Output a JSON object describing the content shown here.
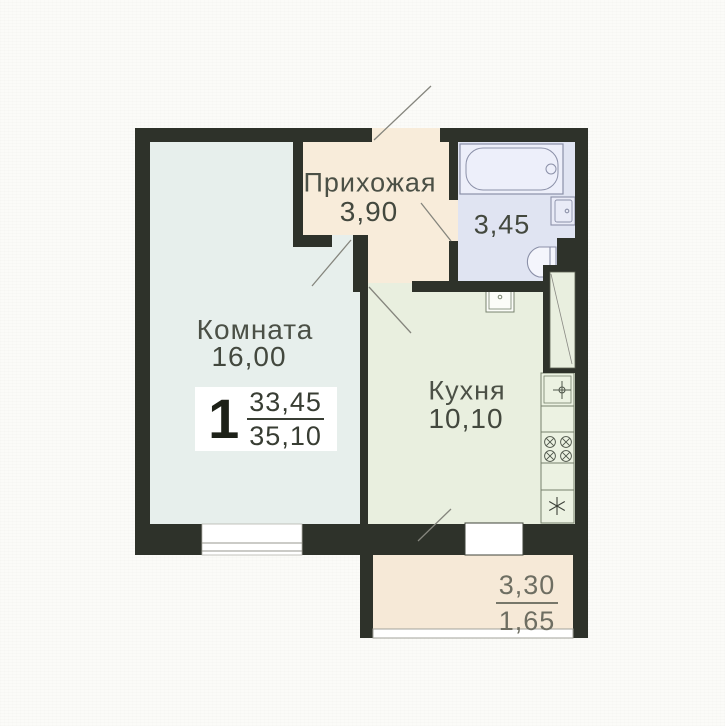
{
  "floor_plan": {
    "rooms": [
      {
        "id": "hallway",
        "name": "Прихожая",
        "area": "3,90"
      },
      {
        "id": "living-room",
        "name": "Комната",
        "area": "16,00"
      },
      {
        "id": "kitchen",
        "name": "Кухня",
        "area": "10,10"
      },
      {
        "id": "bathroom",
        "name": "",
        "area": "3,45"
      }
    ],
    "balcony": {
      "area_full": "3,30",
      "area_reduced": "1,65"
    },
    "info_badge": {
      "room_count": "1",
      "living_area": "33,45",
      "total_area": "35,10"
    },
    "colors": {
      "wall": "#2e322a",
      "living_room_floor": "#e7efec",
      "kitchen_floor": "#e9efdf",
      "hallway_floor": "#f8ecda",
      "bathroom_floor": "#e0e4f2",
      "balcony_floor": "#f6e9d7",
      "fixture_outline": "#8b90a8"
    }
  }
}
